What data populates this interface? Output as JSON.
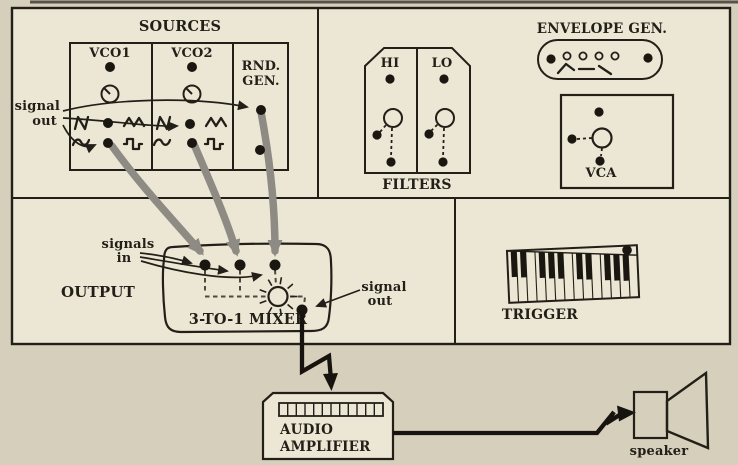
{
  "colors": {
    "page_background": "#d6cfbc",
    "panel_fill": "#ece7d4",
    "line": "#221f19",
    "cable_gray": "#8d8b84"
  },
  "sources": {
    "title": "SOURCES",
    "vco1_label": "VCO1",
    "vco2_label": "VCO2",
    "rnd_gen_label": [
      "RND.",
      "GEN."
    ],
    "signal_out_label": [
      "signal",
      "out"
    ]
  },
  "filters": {
    "title": "FILTERS",
    "hi_label": "HI",
    "lo_label": "LO"
  },
  "envelope_gen": {
    "title": "ENVELOPE GEN."
  },
  "vca": {
    "label": "VCA"
  },
  "output": {
    "title": "OUTPUT",
    "signals_in_label": [
      "signals",
      "in"
    ],
    "mixer_label": "3-TO-1 MIXER",
    "signal_out_label": [
      "signal",
      "out"
    ]
  },
  "trigger": {
    "title": "TRIGGER"
  },
  "amplifier": {
    "label": [
      "AUDIO",
      "AMPLIFIER"
    ]
  },
  "speaker": {
    "label": "speaker"
  },
  "icons": {
    "knob": "knob-icon",
    "sawtooth": "sawtooth-wave-icon",
    "triangle": "triangle-wave-icon",
    "sine": "sine-wave-icon",
    "square": "square-wave-icon",
    "envelope_curve": "envelope-curve-icon",
    "mixer_sun": "sun-burst-icon",
    "keyboard": "keyboard-icon",
    "grille": "amplifier-grille-icon",
    "speaker_horn": "speaker-horn-icon",
    "patch_cable": "patch-cable",
    "jack": "jack-dot"
  }
}
